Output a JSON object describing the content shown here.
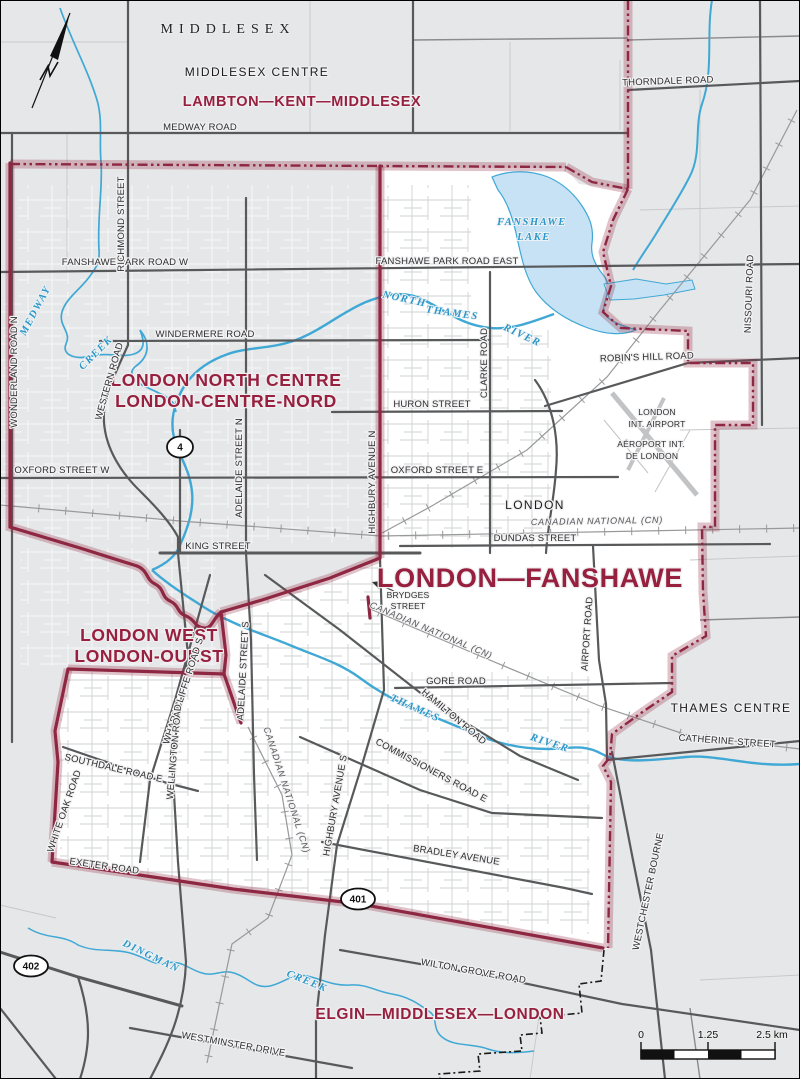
{
  "map": {
    "colors": {
      "background": "#E6E7E8",
      "district_fill": "#FFFFFF",
      "boundary_line": "#8E2742",
      "district_text": "#97203F",
      "water_line": "#3FA8D5",
      "water_fill": "#C7E2F4",
      "road_major": "#58595B"
    },
    "labels": [
      {
        "text": "MIDDLESEX",
        "x": 228,
        "y": 33,
        "cls": "serifcap"
      },
      {
        "text": "MIDDLESEX CENTRE",
        "x": 257,
        "y": 76,
        "cls": "muni",
        "size": 11.5
      },
      {
        "text": "THAMES CENTRE",
        "x": 731,
        "y": 712,
        "cls": "muni",
        "size": 13
      },
      {
        "text": "LONDON",
        "x": 535,
        "y": 509,
        "cls": "muni",
        "size": 13,
        "ls": 2.5
      },
      {
        "text": "LAMBTON—KENT—MIDDLESEX",
        "x": 302,
        "y": 106,
        "cls": "district",
        "size": 14.5
      },
      {
        "text": "LONDON NORTH CENTRE",
        "x": 226,
        "y": 386,
        "cls": "district",
        "size": 17.5
      },
      {
        "text": "LONDON-CENTRE-NORD",
        "x": 226,
        "y": 407,
        "cls": "district",
        "size": 17.5
      },
      {
        "text": "LONDON WEST",
        "x": 149,
        "y": 641,
        "cls": "district",
        "size": 17.5
      },
      {
        "text": "LONDON-OUEST",
        "x": 149,
        "y": 662,
        "cls": "district",
        "size": 17.5
      },
      {
        "text": "LONDON—FANSHAWE",
        "x": 530,
        "y": 587,
        "cls": "district",
        "size": 27,
        "ls": 3
      },
      {
        "text": "ELGIN—MIDDLESEX—LONDON",
        "x": 440,
        "y": 1019,
        "cls": "district",
        "size": 15.5
      },
      {
        "text": "MEDWAY ROAD",
        "x": 200,
        "y": 130,
        "cls": "rl"
      },
      {
        "text": "THORNDALE ROAD",
        "x": 668,
        "y": 84,
        "rot": -2,
        "cls": "rl"
      },
      {
        "text": "FANSHAWE PARK ROAD W",
        "x": 125,
        "y": 265,
        "cls": "rl"
      },
      {
        "text": "FANSHAWE PARK ROAD EAST",
        "x": 447,
        "y": 264,
        "cls": "rl"
      },
      {
        "text": "WINDERMERE ROAD",
        "x": 205,
        "y": 337,
        "cls": "rl"
      },
      {
        "text": "HURON STREET",
        "x": 432,
        "y": 407,
        "cls": "rl"
      },
      {
        "text": "OXFORD STREET W",
        "x": 62,
        "y": 473,
        "cls": "rl"
      },
      {
        "text": "OXFORD STREET E",
        "x": 437,
        "y": 473,
        "cls": "rl"
      },
      {
        "text": "KING STREET",
        "x": 218,
        "y": 549,
        "cls": "rl"
      },
      {
        "text": "DUNDAS STREET",
        "x": 535,
        "y": 541,
        "cls": "rl"
      },
      {
        "text": "GORE ROAD",
        "x": 456,
        "y": 684,
        "cls": "rl"
      },
      {
        "text": "ROBIN'S HILL ROAD",
        "x": 647,
        "y": 360,
        "rot": -2,
        "cls": "rl"
      },
      {
        "text": "CATHERINE STREET",
        "x": 727,
        "y": 744,
        "rot": 4,
        "cls": "rl"
      },
      {
        "text": "BRYDGES",
        "x": 408,
        "y": 598,
        "cls": "rls"
      },
      {
        "text": "STREET",
        "x": 408,
        "y": 609,
        "cls": "rls"
      },
      {
        "text": "SOUTHDALE ROAD E",
        "x": 113,
        "y": 771,
        "rot": 13,
        "cls": "rl"
      },
      {
        "text": "EXETER ROAD",
        "x": 104,
        "y": 869,
        "rot": 8,
        "cls": "rl"
      },
      {
        "text": "BRADLEY AVENUE",
        "x": 456,
        "y": 858,
        "rot": 9,
        "cls": "rl"
      },
      {
        "text": "WILTON GROVE ROAD",
        "x": 473,
        "y": 974,
        "rot": 10,
        "cls": "rl"
      },
      {
        "text": "WESTMINSTER DRIVE",
        "x": 233,
        "y": 1047,
        "rot": 10,
        "cls": "rl"
      },
      {
        "text": "COMMISSIONERS ROAD E",
        "x": 430,
        "y": 773,
        "rot": 28,
        "cls": "rl"
      },
      {
        "text": "HAMILTON ROAD",
        "x": 452,
        "y": 719,
        "rot": 40,
        "cls": "rl"
      },
      {
        "text": "WHARNCLIFFE ROAD S",
        "x": 186,
        "y": 692,
        "rot": -72,
        "cls": "rl"
      },
      {
        "text": "WELLINGTON ROAD",
        "x": 177,
        "y": 752,
        "rot": -85,
        "cls": "rl"
      },
      {
        "text": "WHITE OAK ROAD",
        "x": 67,
        "y": 812,
        "rot": -71,
        "cls": "rl"
      },
      {
        "text": "ADELAIDE STREET N",
        "x": 242,
        "y": 468,
        "rot": -90,
        "cls": "rl"
      },
      {
        "text": "ADELAIDE STREET S",
        "x": 246,
        "y": 671,
        "rot": -87,
        "cls": "rl"
      },
      {
        "text": "HIGHBURY AVENUE N",
        "x": 375,
        "y": 482,
        "rot": -90,
        "cls": "rl"
      },
      {
        "text": "HIGHBURY AVENUE S",
        "x": 338,
        "y": 806,
        "rot": -80,
        "cls": "rl"
      },
      {
        "text": "CLARKE ROAD",
        "x": 487,
        "y": 363,
        "rot": -90,
        "cls": "rl"
      },
      {
        "text": "AIRPORT ROAD",
        "x": 590,
        "y": 634,
        "rot": -86,
        "cls": "rl"
      },
      {
        "text": "NISSOURI ROAD",
        "x": 752,
        "y": 294,
        "rot": -88,
        "cls": "rl"
      },
      {
        "text": "WESTCHESTER BOURNE",
        "x": 651,
        "y": 892,
        "rot": -78,
        "cls": "rl"
      },
      {
        "text": "RICHMOND STREET",
        "x": 124,
        "y": 224,
        "rot": -90,
        "cls": "rl"
      },
      {
        "text": "WONDERLAND ROAD N",
        "x": 17,
        "y": 372,
        "rot": -90,
        "cls": "rl"
      },
      {
        "text": "WESTERN ROAD",
        "x": 112,
        "y": 382,
        "rot": -74,
        "cls": "rl"
      },
      {
        "text": "LONDON",
        "x": 657,
        "y": 415,
        "cls": "rls"
      },
      {
        "text": "INT. AIRPORT",
        "x": 657,
        "y": 427,
        "cls": "rls"
      },
      {
        "text": "AÉROPORT INT.",
        "x": 651,
        "y": 447,
        "cls": "rls"
      },
      {
        "text": "DE LONDON",
        "x": 652,
        "y": 459,
        "cls": "rls"
      },
      {
        "text": "FANSHAWE",
        "x": 532,
        "y": 225,
        "cls": "water"
      },
      {
        "text": "LAKE",
        "x": 534,
        "y": 240,
        "cls": "water"
      },
      {
        "text": "NORTH",
        "x": 404,
        "y": 302,
        "rot": 12,
        "cls": "water"
      },
      {
        "text": "THAMES",
        "x": 452,
        "y": 316,
        "rot": 8,
        "cls": "water"
      },
      {
        "text": "RIVER",
        "x": 521,
        "y": 338,
        "rot": 25,
        "cls": "water"
      },
      {
        "text": "MEDWAY",
        "x": 38,
        "y": 312,
        "rot": -62,
        "cls": "water"
      },
      {
        "text": "CREEK",
        "x": 98,
        "y": 355,
        "rot": -45,
        "cls": "water"
      },
      {
        "text": "THAMES",
        "x": 414,
        "y": 711,
        "rot": 24,
        "cls": "water"
      },
      {
        "text": "RIVER",
        "x": 549,
        "y": 746,
        "rot": 18,
        "cls": "water"
      },
      {
        "text": "DINGMAN",
        "x": 150,
        "y": 959,
        "rot": 26,
        "cls": "water"
      },
      {
        "text": "CREEK",
        "x": 306,
        "y": 984,
        "rot": 22,
        "cls": "water"
      },
      {
        "text": "CANADIAN NATIONAL (CN)",
        "x": 597,
        "y": 524,
        "rot": -1,
        "cls": "rail"
      },
      {
        "text": "CANADIAN NATIONAL (CN)",
        "x": 430,
        "y": 633,
        "rot": 23,
        "cls": "rail"
      },
      {
        "text": "CANADIAN NATIONAL (CN)",
        "x": 284,
        "y": 791,
        "rot": 72,
        "cls": "rail"
      }
    ],
    "shields": [
      {
        "text": "4",
        "x": 180,
        "y": 447
      },
      {
        "text": "401",
        "x": 358,
        "y": 899
      },
      {
        "text": "402",
        "x": 31,
        "y": 966
      }
    ],
    "scale_bar": {
      "tick_labels": [
        "0",
        "1.25",
        "2.5 km"
      ],
      "tick_x": [
        641,
        708,
        772
      ],
      "label_y": 1038
    }
  }
}
